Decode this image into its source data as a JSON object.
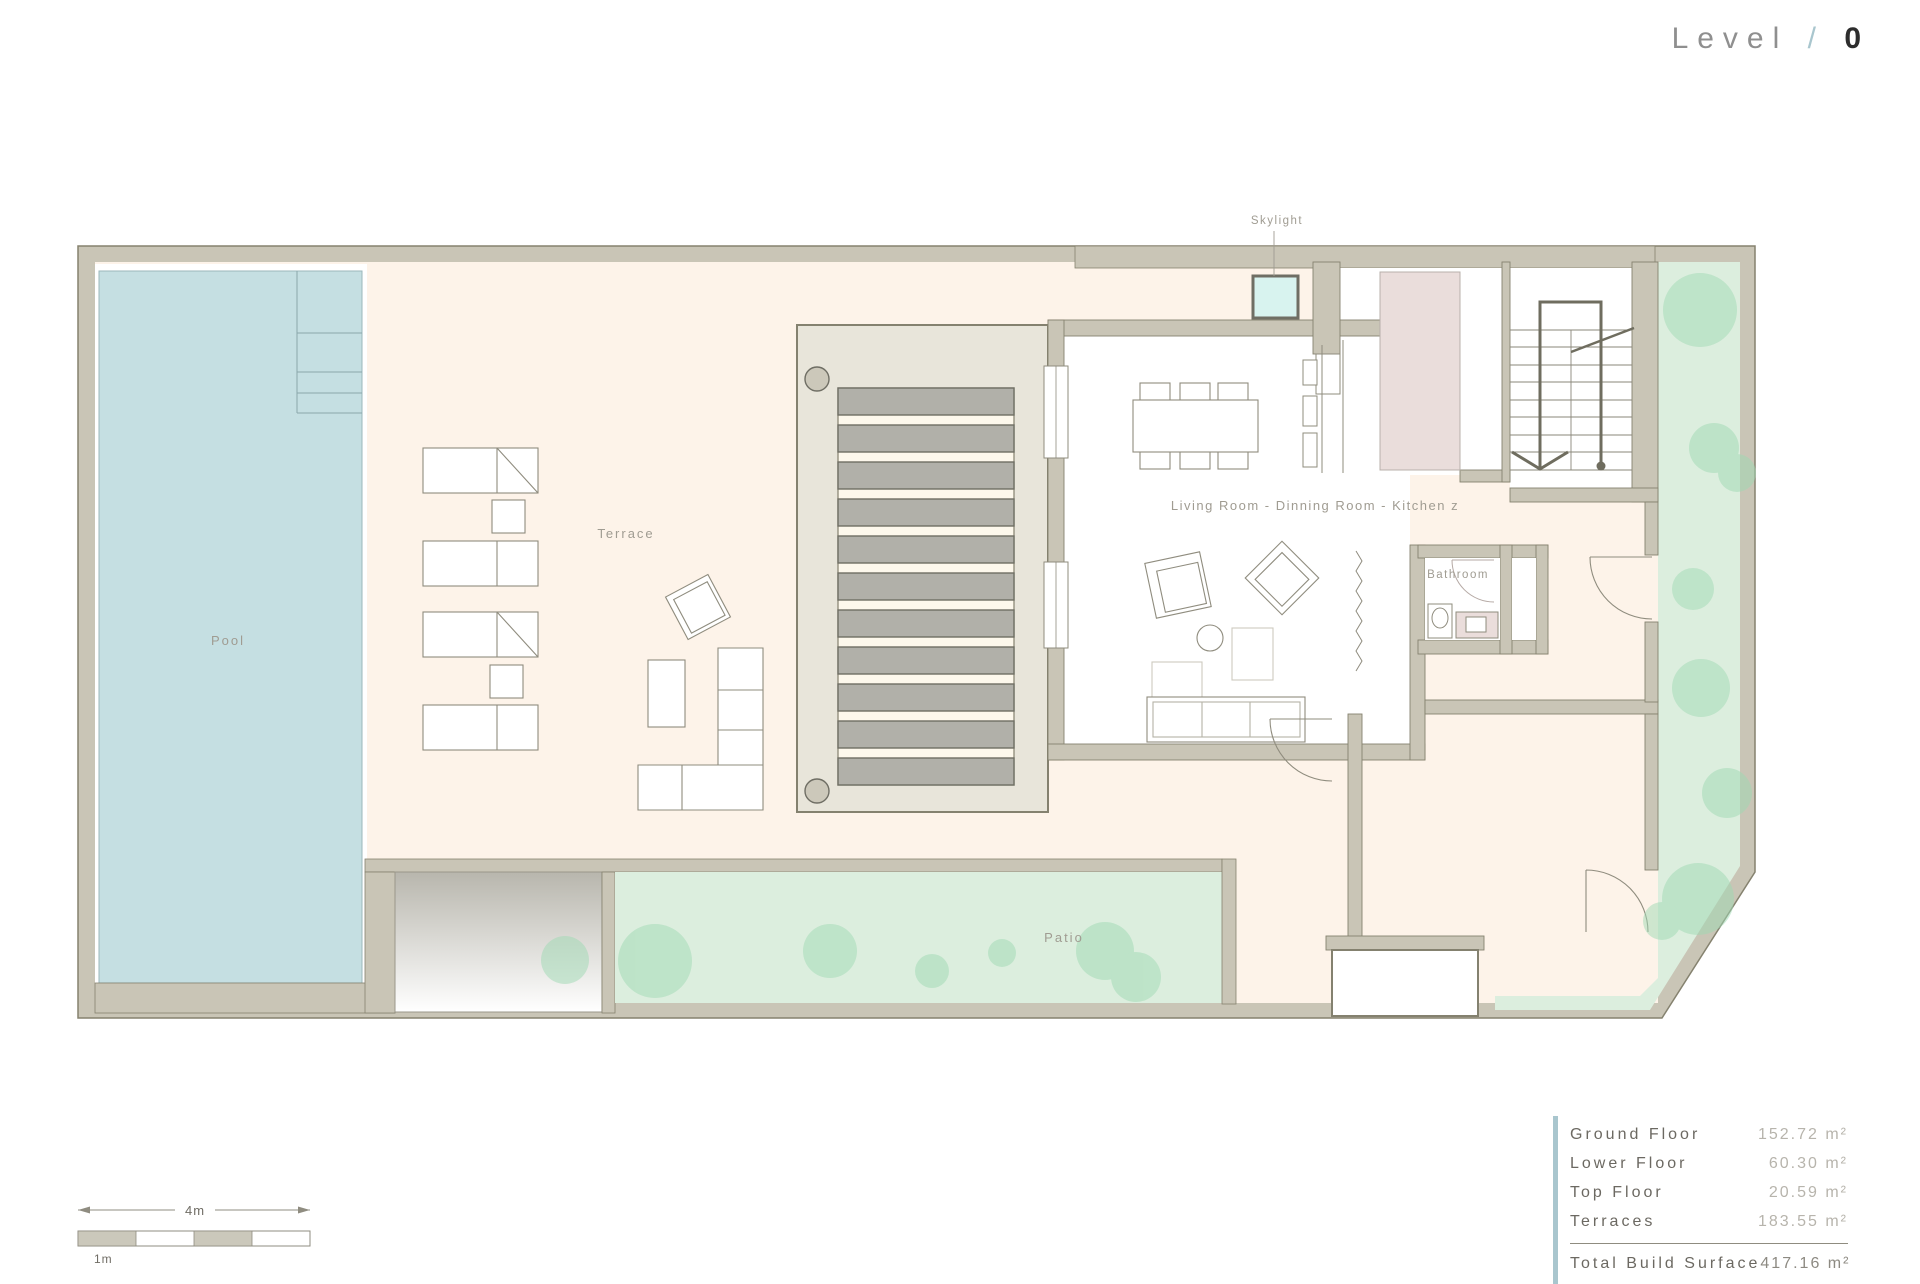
{
  "title": {
    "word": "Level",
    "slash": "/",
    "number": "0"
  },
  "floor_labels": {
    "skylight": "Skylight",
    "terrace": "Terrace",
    "pool": "Pool",
    "living_room": "Living Room - Dinning Room - Kitchen z",
    "bathroom": "Bathroom",
    "patio": "Patio"
  },
  "summary": {
    "rows": [
      {
        "label": "Ground Floor",
        "value": "152.72 m²"
      },
      {
        "label": "Lower Floor",
        "value": "60.30 m²"
      },
      {
        "label": "Top Floor",
        "value": "20.59 m²"
      },
      {
        "label": "Terraces",
        "value": "183.55 m²"
      }
    ],
    "total": {
      "label": "Total Build Surface",
      "value": "417.16 m²"
    }
  },
  "scale_bar": {
    "span_label": "4m",
    "segment_label": "1m"
  },
  "colors": {
    "accent_blue": "#a9c6ce",
    "wall": "#c9c5b6",
    "pool_water": "#c5dfe2",
    "terrace_cream": "#fdf3e9",
    "garden_green": "#dceede",
    "tree_green": "#9fdab4",
    "skylight_cyan": "#d8f3ef",
    "kitchen_pink": "#eadddb",
    "slat_gray": "#b1b0a9"
  }
}
